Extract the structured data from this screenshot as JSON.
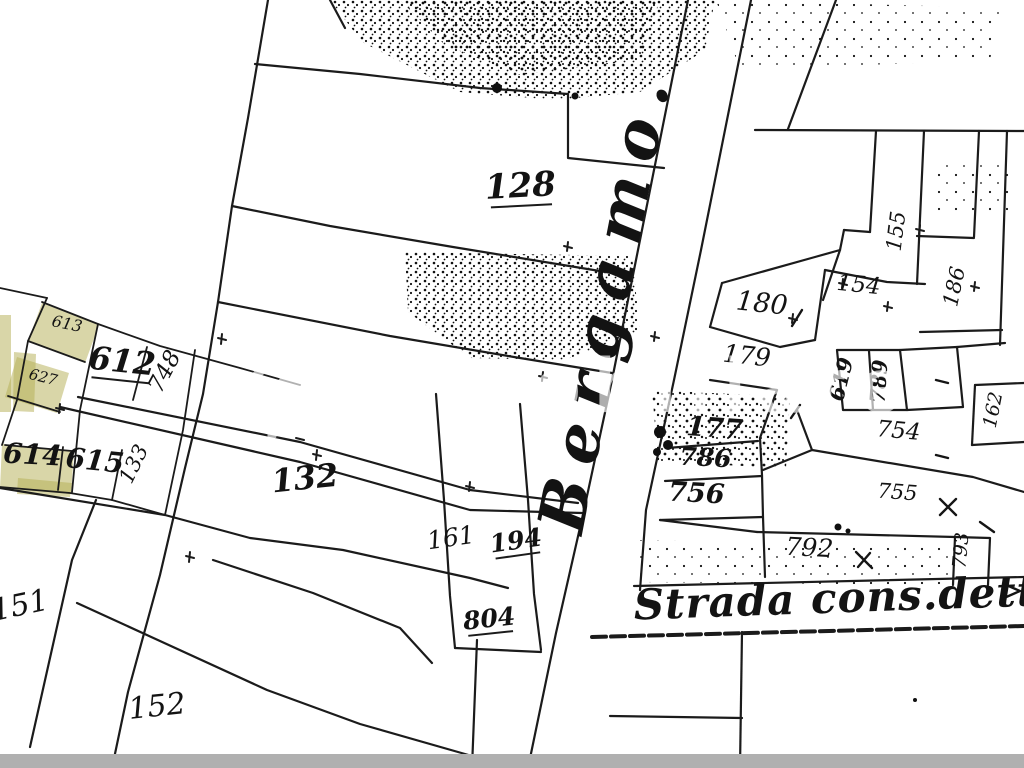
{
  "map": {
    "parcel_labels": [
      {
        "id": "128",
        "text": "128",
        "x": 521,
        "y": 197,
        "size": 34,
        "rot": -3,
        "bold": true,
        "underline": true
      },
      {
        "id": "132",
        "text": "132",
        "x": 306,
        "y": 489,
        "size": 32,
        "rot": -6,
        "bold": true,
        "underline": false
      },
      {
        "id": "161",
        "text": "161",
        "x": 452,
        "y": 546,
        "size": 25,
        "rot": -8,
        "bold": false,
        "underline": false
      },
      {
        "id": "194",
        "text": "194",
        "x": 517,
        "y": 549,
        "size": 25,
        "rot": -8,
        "bold": true,
        "underline": true
      },
      {
        "id": "804",
        "text": "804",
        "x": 490,
        "y": 627,
        "size": 25,
        "rot": -6,
        "bold": true,
        "underline": true
      },
      {
        "id": "151",
        "text": "151",
        "x": 22,
        "y": 615,
        "size": 30,
        "rot": -12,
        "bold": false,
        "underline": false
      },
      {
        "id": "152",
        "text": "152",
        "x": 158,
        "y": 716,
        "size": 30,
        "rot": -6,
        "bold": false,
        "underline": false
      },
      {
        "id": "612",
        "text": "612",
        "x": 121,
        "y": 372,
        "size": 32,
        "rot": 6,
        "bold": true,
        "underline": true
      },
      {
        "id": "748",
        "text": "748",
        "x": 171,
        "y": 375,
        "size": 23,
        "rot": -62,
        "bold": false,
        "underline": false
      },
      {
        "id": "613",
        "text": "613",
        "x": 66,
        "y": 329,
        "size": 16,
        "rot": 12,
        "bold": false,
        "underline": false
      },
      {
        "id": "627",
        "text": "627",
        "x": 42,
        "y": 382,
        "size": 15,
        "rot": 14,
        "bold": false,
        "underline": false
      },
      {
        "id": "614",
        "text": "614",
        "x": 32,
        "y": 464,
        "size": 28,
        "rot": 3,
        "bold": true,
        "underline": false
      },
      {
        "id": "615",
        "text": "615",
        "x": 94,
        "y": 470,
        "size": 28,
        "rot": 6,
        "bold": true,
        "underline": false
      },
      {
        "id": "133",
        "text": "133",
        "x": 140,
        "y": 467,
        "size": 21,
        "rot": -64,
        "bold": false,
        "underline": false
      },
      {
        "id": "180",
        "text": "180",
        "x": 761,
        "y": 312,
        "size": 27,
        "rot": 6,
        "bold": false,
        "underline": false
      },
      {
        "id": "179",
        "text": "179",
        "x": 746,
        "y": 364,
        "size": 25,
        "rot": 6,
        "bold": false,
        "underline": false
      },
      {
        "id": "154",
        "text": "154",
        "x": 858,
        "y": 292,
        "size": 23,
        "rot": 6,
        "bold": false,
        "underline": false
      },
      {
        "id": "155",
        "text": "155",
        "x": 903,
        "y": 232,
        "size": 21,
        "rot": -83,
        "bold": false,
        "underline": false
      },
      {
        "id": "186",
        "text": "186",
        "x": 961,
        "y": 288,
        "size": 21,
        "rot": -78,
        "bold": false,
        "underline": false
      },
      {
        "id": "619",
        "text": "619",
        "x": 848,
        "y": 381,
        "size": 21,
        "rot": -76,
        "bold": true,
        "underline": false
      },
      {
        "id": "789",
        "text": "789",
        "x": 886,
        "y": 382,
        "size": 21,
        "rot": -86,
        "bold": true,
        "underline": false
      },
      {
        "id": "177",
        "text": "177",
        "x": 714,
        "y": 437,
        "size": 27,
        "rot": 4,
        "bold": true,
        "underline": false
      },
      {
        "id": "786",
        "text": "786",
        "x": 705,
        "y": 466,
        "size": 25,
        "rot": 3,
        "bold": true,
        "underline": false
      },
      {
        "id": "756",
        "text": "756",
        "x": 696,
        "y": 502,
        "size": 27,
        "rot": 3,
        "bold": true,
        "underline": false
      },
      {
        "id": "754",
        "text": "754",
        "x": 898,
        "y": 438,
        "size": 23,
        "rot": 5,
        "bold": false,
        "underline": false
      },
      {
        "id": "755",
        "text": "755",
        "x": 897,
        "y": 499,
        "size": 21,
        "rot": 4,
        "bold": false,
        "underline": false
      },
      {
        "id": "792",
        "text": "792",
        "x": 809,
        "y": 556,
        "size": 25,
        "rot": 3,
        "bold": false,
        "underline": false
      },
      {
        "id": "793",
        "text": "793",
        "x": 967,
        "y": 551,
        "size": 19,
        "rot": -85,
        "bold": false,
        "underline": false
      },
      {
        "id": "162",
        "text": "162",
        "x": 999,
        "y": 411,
        "size": 19,
        "rot": -79,
        "bold": false,
        "underline": false
      }
    ],
    "road_labels": [
      {
        "id": "bergamo",
        "text": "Bergamo.",
        "x": 627,
        "y": 303,
        "size": 64,
        "rot": -79,
        "spacing": 16
      },
      {
        "id": "strada",
        "text": "Strada cons.detta",
        "x": 850,
        "y": 612,
        "size": 42,
        "rot": -2,
        "spacing": 1
      }
    ],
    "watermark": {
      "text": "immobiliare",
      "icon": "house-icon"
    },
    "colors": {
      "background": "#ffffff",
      "line": "#1b1b1b",
      "highlight": "#b4ae52",
      "highlight_opacity": "0.5",
      "bottom_bar": "#b0b0b0",
      "watermark": "rgba(255,255,255,0.66)",
      "stipple": "#111111"
    }
  }
}
